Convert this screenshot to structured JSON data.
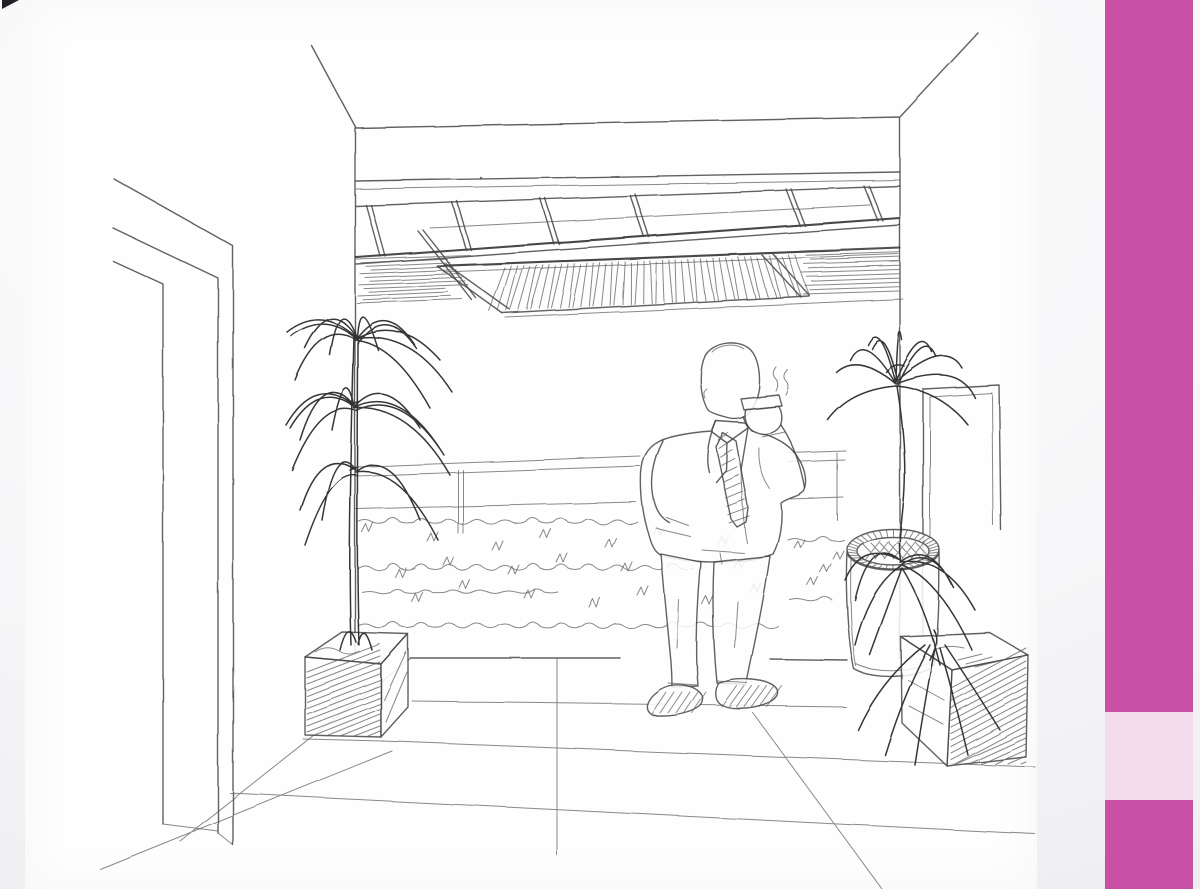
{
  "window": {
    "type": "presentation-slide",
    "visible_text": "none"
  },
  "theme": {
    "colors": {
      "accent": "#c951a5",
      "accent_light": "#f2dcec",
      "paper": "#fefefe",
      "pencil": "#4a4a4a",
      "pencil_dark": "#2d2d2d",
      "background_edge": "#e8e8ec",
      "corner_mark": "#222226"
    }
  },
  "sketch": {
    "description": "Hand-drawn pencil perspective sketch of a lobby terrace: a man in a suit stands smoking beside a low scribbled hedge and railing; a tall potted plant in a hatched square planter on the left, a cylindrical ashtray bin and a second leafy plant in a square planter on the right; coffered ceiling grid with a slatted louver panel above; tiled floor in one-point perspective; open door frame on the left wall.",
    "elements": [
      "door-frame",
      "wall-corners",
      "ceiling-grid",
      "louver-panel",
      "railing",
      "hedge",
      "tiled-floor",
      "left-planter-box",
      "left-potted-plant",
      "man-in-suit",
      "cigarette-smoke",
      "ashtray-bin",
      "wall-frame",
      "right-potted-plant",
      "right-planter-box"
    ]
  },
  "accent_bar": {
    "position": "right",
    "has_highlight_block": true
  }
}
